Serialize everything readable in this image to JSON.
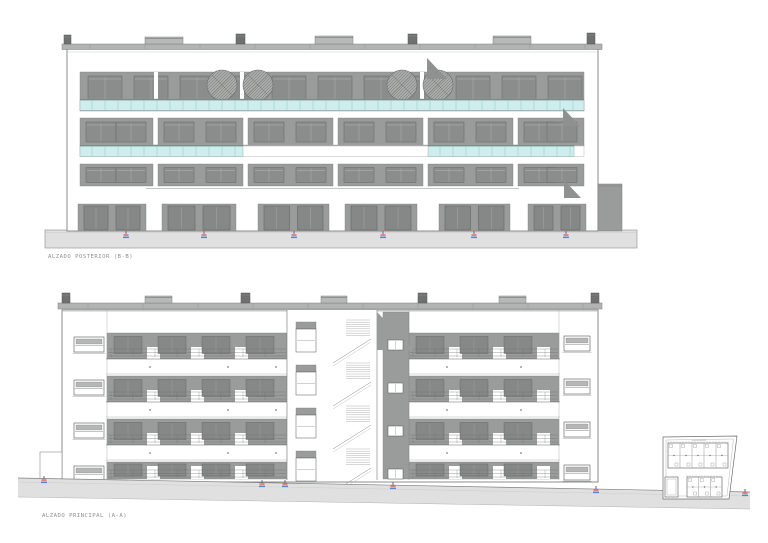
{
  "labels": {
    "posterior": "ALZADO POSTERIOR (B-B)",
    "principal": "ALZADO PRINCIPAL (A-A)"
  },
  "drawing": {
    "canvas": {
      "w": 768,
      "h": 543
    },
    "colors": {
      "wall": "#9a9c9b",
      "window": "#8b8d8c",
      "window_frame": "#64666a",
      "opening": "#868887",
      "cyan": "#cdeeec",
      "cyan_mullion": "#93c2bf",
      "cyan_edge": "#7fa9a6",
      "parapet": "#b2b4b3",
      "chimney_dark": "#6f7170",
      "chimney_light": "#b7b9b8",
      "ground": "#e0e0e0",
      "ground_line": "#8a8c8b",
      "outline": "#6f7170",
      "line": "#7e807f",
      "shadow": "#8f9190",
      "white": "#ffffff",
      "marker_red": "#e4685f",
      "marker_blue": "#4f86d8",
      "text": "#8f8f8f",
      "plant": "#a9abaa",
      "plant_hatch": "#737573"
    },
    "posterior": {
      "ground": {
        "x": 45,
        "y": 230,
        "w": 592,
        "h": 18
      },
      "markers_x": [
        126,
        204,
        294,
        383,
        474,
        566
      ],
      "body": {
        "x": 67,
        "y": 49,
        "w": 531,
        "h": 182
      },
      "parapet": {
        "x": 62,
        "y": 44,
        "w": 540,
        "h": 5.5
      },
      "chimneys": [
        {
          "x": 64,
          "w": 7,
          "h": 9,
          "dark": true
        },
        {
          "x": 145,
          "w": 38,
          "h": 7,
          "dark": false
        },
        {
          "x": 236,
          "w": 9,
          "h": 10,
          "dark": true
        },
        {
          "x": 315,
          "w": 38,
          "h": 8,
          "dark": false
        },
        {
          "x": 408,
          "w": 9,
          "h": 10,
          "dark": true
        },
        {
          "x": 493,
          "w": 38,
          "h": 8,
          "dark": false
        },
        {
          "x": 587,
          "w": 8,
          "h": 11,
          "dark": true
        }
      ],
      "top_band": {
        "x": 80,
        "y": 72,
        "w": 504,
        "h": 39
      },
      "top_windows": {
        "start": 88,
        "step": 46,
        "count": 11,
        "w": 34,
        "y": 76,
        "h": 25
      },
      "slits": [
        154,
        240,
        420
      ],
      "plants": [
        222,
        258,
        402,
        438
      ],
      "balustrade": {
        "x": 80,
        "y": 99,
        "w": 504,
        "h": 11.5
      },
      "f3": {
        "y": 118,
        "h": 28,
        "win_y": 122,
        "win_h": 20,
        "modules": [
          [
            80,
            73
          ],
          [
            158,
            85
          ],
          [
            248,
            85
          ],
          [
            338,
            85
          ],
          [
            428,
            85
          ],
          [
            518,
            66
          ]
        ]
      },
      "f3_parapet": {
        "y": 145,
        "h": 11.5,
        "x": 80,
        "w": 504,
        "cyan": [
          [
            80,
            163
          ],
          [
            428,
            146
          ]
        ]
      },
      "f2": {
        "y": 164,
        "h": 22,
        "win_y": 167.5,
        "win_h": 15
      },
      "mid_line": {
        "x1": 146,
        "y": 188.5,
        "x2": 519
      },
      "gf": {
        "y": 204,
        "h": 27,
        "open_y": 206,
        "open_h": 24,
        "panels": [
          [
            78,
            68
          ],
          [
            162,
            74
          ],
          [
            258,
            71
          ],
          [
            345,
            72
          ],
          [
            439,
            71
          ],
          [
            528,
            58
          ]
        ]
      },
      "annex": {
        "x": 598,
        "y": 184,
        "w": 24,
        "h": 47
      },
      "shadows": [
        [
          427,
          58,
          20,
          21
        ],
        [
          563,
          108,
          17,
          18
        ],
        [
          564,
          180,
          17,
          18
        ]
      ],
      "label_xy": [
        48,
        258
      ]
    },
    "principal": {
      "ground_pts": [
        [
          18,
          478
        ],
        [
          750,
          492
        ],
        [
          750,
          509
        ],
        [
          18,
          497
        ]
      ],
      "markers": [
        [
          44,
          479
        ],
        [
          262,
          483
        ],
        [
          285,
          483
        ],
        [
          393,
          485
        ],
        [
          596,
          489
        ],
        [
          745,
          492
        ]
      ],
      "body": {
        "x": 62,
        "y": 310,
        "w": 536,
        "h": 172
      },
      "parapet": {
        "x": 58,
        "y": 303,
        "w": 544,
        "h": 6
      },
      "chimneys": [
        {
          "x": 62,
          "w": 8,
          "h": 10,
          "dark": true
        },
        {
          "x": 145,
          "w": 27,
          "h": 7,
          "dark": false
        },
        {
          "x": 241,
          "w": 9,
          "h": 10,
          "dark": true
        },
        {
          "x": 321,
          "w": 26,
          "h": 7,
          "dark": false
        },
        {
          "x": 418,
          "w": 9,
          "h": 10,
          "dark": true
        },
        {
          "x": 499,
          "w": 27,
          "h": 7,
          "dark": false
        },
        {
          "x": 591,
          "w": 8,
          "h": 10,
          "dark": true
        }
      ],
      "left_wall_windows": {
        "x": 74,
        "w": 30,
        "h": 15,
        "ys": [
          337,
          380,
          423,
          466
        ]
      },
      "right_wall_windows": {
        "x": 564,
        "w": 26,
        "h": 15,
        "ys": [
          336,
          379,
          422,
          465
        ]
      },
      "wings": [
        {
          "x": 107,
          "w": 180
        },
        {
          "x": 409,
          "w": 150
        }
      ],
      "floors": {
        "ys": [
          333,
          376,
          419,
          462
        ],
        "band_h": 26,
        "gf_h": 17,
        "slab_h": 17
      },
      "tower": {
        "x": 287,
        "w": 90,
        "win_x": 296,
        "win_w": 20,
        "win_h": 23,
        "win_ys": [
          329,
          372,
          415,
          458
        ],
        "stair_ys": [
          320,
          363,
          406,
          449
        ]
      },
      "strip": {
        "x": 383,
        "w": 26,
        "win_ys": [
          340,
          383,
          426,
          469
        ]
      },
      "shadow_pts": [
        [
          377,
          312
        ],
        [
          414,
          350
        ],
        [
          377,
          350
        ]
      ],
      "left_step": {
        "x": 40,
        "y": 452,
        "w": 22,
        "h": 30
      },
      "dots": {
        "left": [
          150,
          228,
          276
        ],
        "right": [
          447,
          521
        ]
      },
      "label_xy": [
        42,
        517
      ]
    },
    "keyplan": {
      "boundary": [
        [
          663,
          437
        ],
        [
          737,
          436
        ],
        [
          729,
          499
        ],
        [
          663,
          499
        ]
      ],
      "inner": [
        [
          666,
          440
        ],
        [
          733.5,
          439
        ],
        [
          727,
          496
        ],
        [
          666,
          496
        ]
      ],
      "main_block": {
        "x": 668,
        "y": 443,
        "w": 60,
        "h": 25,
        "units": 5
      },
      "low_block": {
        "x": 687,
        "y": 477,
        "w": 35,
        "h": 20,
        "units": 3
      },
      "small_block": {
        "x": 665,
        "y": 477,
        "w": 13,
        "h": 20
      },
      "note_smudge": {
        "x": 692,
        "y": 439.5,
        "w": 14,
        "h": 1.2
      }
    }
  }
}
